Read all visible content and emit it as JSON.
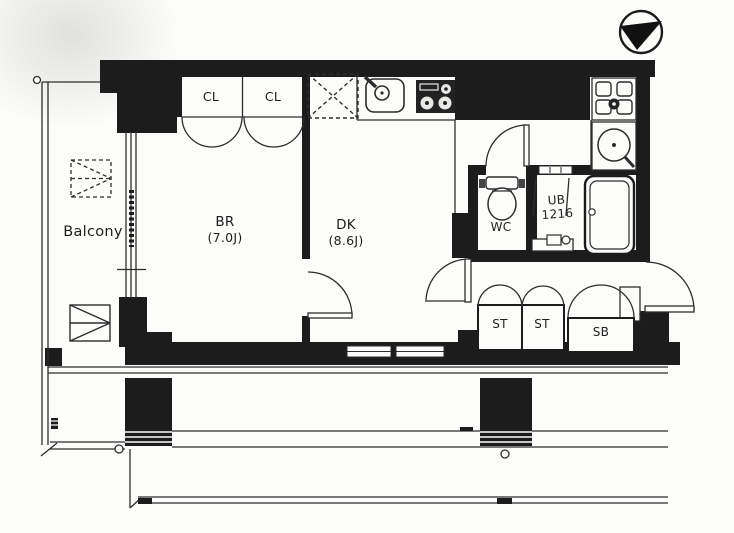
{
  "plan": {
    "rooms": {
      "balcony": {
        "label": "Balcony"
      },
      "closet_left": {
        "label": "CL"
      },
      "closet_right": {
        "label": "CL"
      },
      "bedroom": {
        "name": "BR",
        "area": "(7.0J)"
      },
      "dining_kitchen": {
        "name": "DK",
        "area": "(8.6J)"
      },
      "toilet": {
        "label": "WC"
      },
      "unit_bath": {
        "name": "UB",
        "size": "1216"
      },
      "storage_left": {
        "label": "ST"
      },
      "storage_right": {
        "label": "ST"
      },
      "shoe_box": {
        "label": "SB"
      }
    },
    "icons": {
      "compass": "north-compass-icon",
      "kitchen_sink": "kitchen-sink-icon",
      "stove": "stove-icon",
      "refrigerator_space": "refrigerator-space-box",
      "washer_pan": "washing-machine-pan-icon",
      "wash_basin": "wash-basin-icon",
      "toilet": "toilet-icon",
      "bathtub": "bathtub-icon",
      "escape_hatch": "escape-hatch-icon"
    },
    "colors": {
      "wall": "#1c1c1c",
      "line": "#2d2d2d",
      "paper": "#fcfcfa"
    }
  }
}
